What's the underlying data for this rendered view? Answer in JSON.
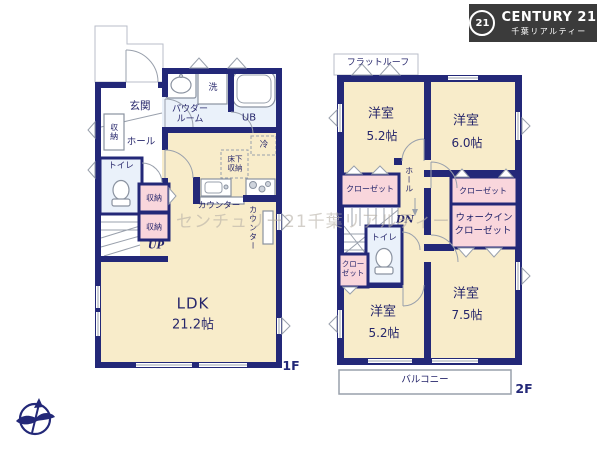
{
  "logo": {
    "badge": "21",
    "brand": "CENTURY 21",
    "subtitle": "千葉リアルティー"
  },
  "watermark": "センチュリー21千葉リアルティー",
  "floor1": {
    "label": "1F",
    "genkan": "玄関",
    "storage_left": "収納",
    "hall": "ホール",
    "toilet": "トイレ",
    "storage_a": "収納",
    "storage_b": "収納",
    "up": "UP",
    "powder_room": "パウダールーム",
    "laundry": "洗",
    "unit_bath": "UB",
    "fridge": "冷",
    "underfloor": "床下収納",
    "counter": "カウンター",
    "counter_side": "カウンター",
    "ldk": "LDK",
    "ldk_size": "21.2帖"
  },
  "floor2": {
    "label": "2F",
    "flat_roof": "フラットルーフ",
    "bedroom_nw": {
      "name": "洋室",
      "size": "5.2帖"
    },
    "bedroom_ne": {
      "name": "洋室",
      "size": "6.0帖"
    },
    "bedroom_sw": {
      "name": "洋室",
      "size": "5.2帖"
    },
    "bedroom_se": {
      "name": "洋室",
      "size": "7.5帖"
    },
    "closet_left": "クローゼット",
    "closet_right": "クローゼット",
    "walkin_1": "ウォークイン",
    "walkin_2": "クローゼット",
    "closet_sw": "クローゼット",
    "hall": "ホール",
    "dn": "DN",
    "toilet": "トイレ",
    "balcony": "バルコニー"
  }
}
